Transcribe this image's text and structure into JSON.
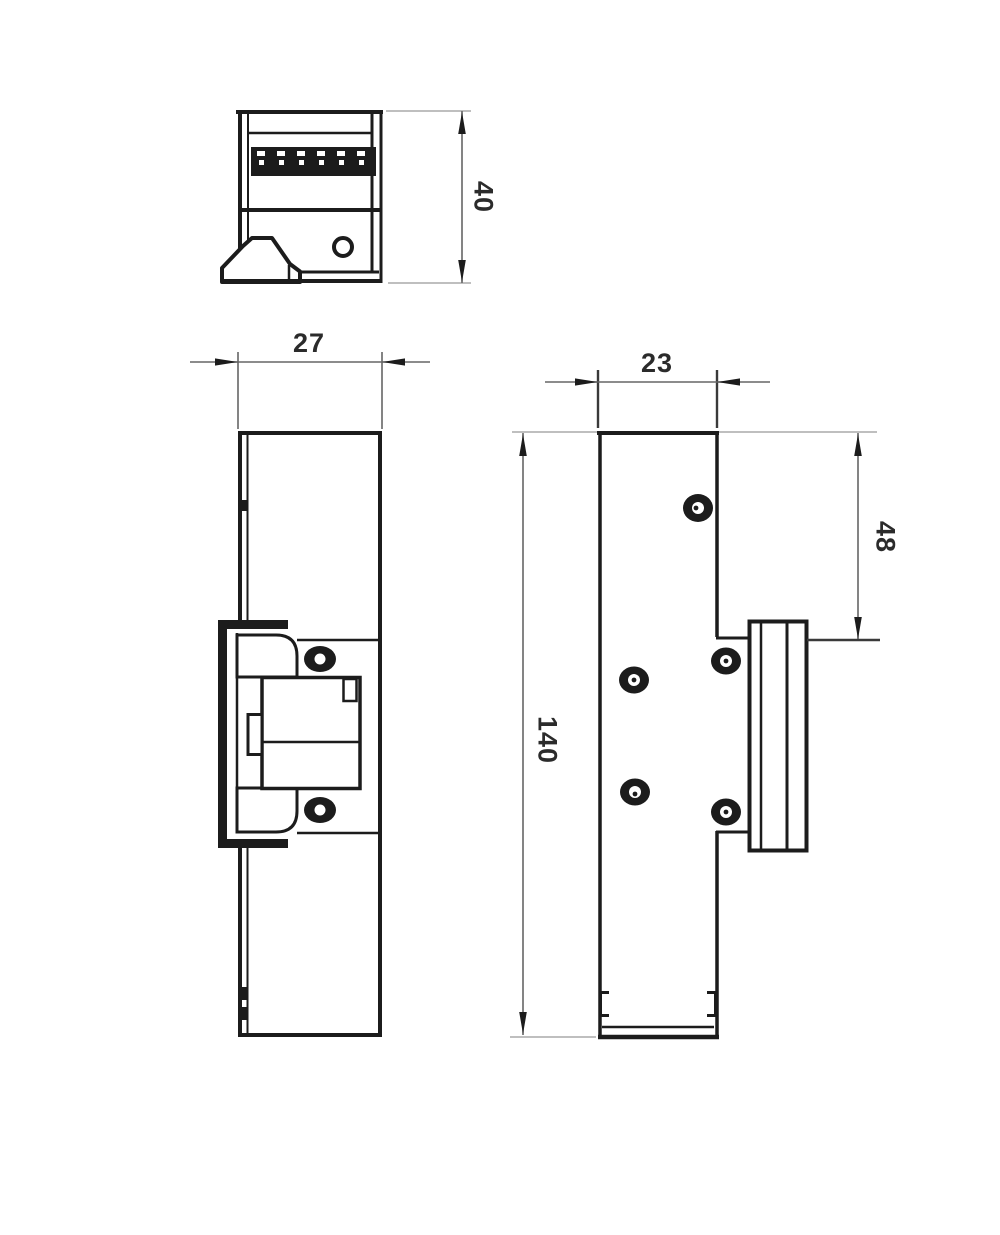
{
  "drawing": {
    "type": "technical-dimension-drawing",
    "part": "door-strike-three-views",
    "units_implied": "mm",
    "colors": {
      "background": "#ffffff",
      "part_line": "#1c1c1c",
      "dimension_line": "#666666",
      "extension_line": "#999999",
      "text": "#2b2b2b"
    },
    "dims": {
      "d40": "40",
      "d27": "27",
      "d23": "23",
      "d48": "48",
      "d140": "140"
    }
  }
}
